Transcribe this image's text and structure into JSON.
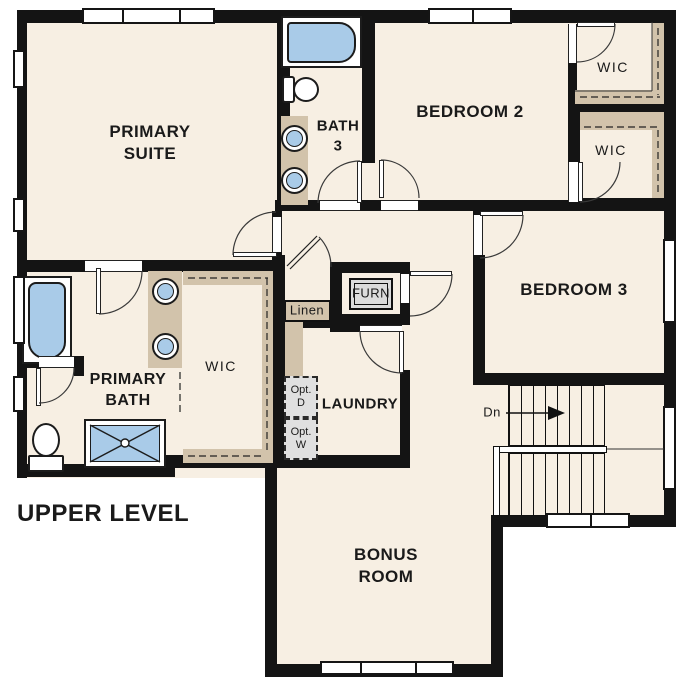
{
  "title": "UPPER LEVEL",
  "colors": {
    "floor": "#f7efe3",
    "wall": "#141414",
    "cabinet_tan": "#d2c3ab",
    "fixture_blue": "#a9cbe8",
    "appliance_gray": "#dcdcdc",
    "line": "#3a3a3a"
  },
  "rooms": {
    "primary_suite": "PRIMARY\nSUITE",
    "bath_3": "BATH\n3",
    "bedroom_2": "BEDROOM 2",
    "bedroom_3": "BEDROOM 3",
    "primary_bath": "PRIMARY\nBATH",
    "bonus_room": "BONUS\nROOM",
    "laundry": "LAUNDRY",
    "wic_bedroom2": "WIC",
    "wic_bedroom3": "WIC",
    "wic_primary": "WIC"
  },
  "annotations": {
    "linen": "Linen",
    "furnace": "FURN",
    "stairs_down": "Dn",
    "opt_dryer": "Opt.\nD",
    "opt_washer": "Opt.\nW"
  }
}
